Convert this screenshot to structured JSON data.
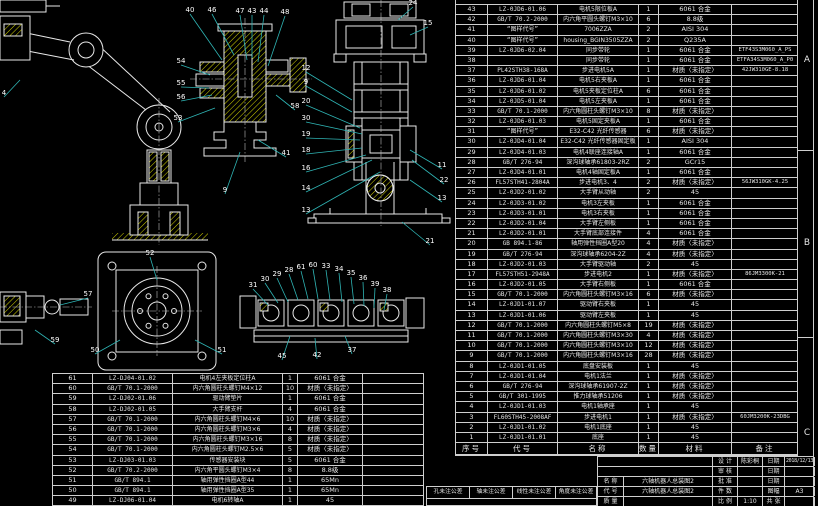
{
  "sheet": {
    "background": "#000000",
    "line_color": "#cfcfcf",
    "hatch_color": "#d6d600",
    "leader_color": "#2fb5b5"
  },
  "zone_letters": [
    "A",
    "B",
    "C"
  ],
  "right_table": {
    "cols": [
      32,
      70,
      81,
      20,
      73,
      66
    ],
    "clipped_top_row": true,
    "header": [
      "序号",
      "代号",
      "名称",
      "数量",
      "材料",
      "备注"
    ],
    "rows": [
      [
        "43",
        "LZ-0JD6-01.06",
        "电机5限位板A",
        "1",
        "6061 合金",
        ""
      ],
      [
        "42",
        "GB/T 70.2-2000",
        "内六角平圆头螺钉M3×10",
        "6",
        "8.8级",
        ""
      ],
      [
        "41",
        "“图样代号”",
        "7006ZZA",
        "2",
        "AISI 304",
        ""
      ],
      [
        "40",
        "“图样代号”",
        "housing_BGIN3505ZZA",
        "2",
        "Q235A",
        ""
      ],
      [
        "39",
        "LZ-0JD6-02.04",
        "同步带轮",
        "1",
        "6061 合金",
        "ETF43S3M060_A_PS"
      ],
      [
        "38",
        "",
        "同步带轮",
        "1",
        "6061 合金",
        "ETFA34S3M060_A_P0"
      ],
      [
        "37",
        "PL42STH38-168A",
        "步进电机5A",
        "1",
        "材质〈未指定〉",
        "42JW310GE-8.18"
      ],
      [
        "36",
        "LZ-0JD6-01.04",
        "电机5右夹板A",
        "1",
        "6061 合金",
        ""
      ],
      [
        "35",
        "LZ-0JD6-01.02",
        "电机5夹板定位柱A",
        "6",
        "6061 合金",
        ""
      ],
      [
        "34",
        "LZ-0JD5-01.04",
        "电机5左夹板A",
        "1",
        "6061 合金",
        ""
      ],
      [
        "33",
        "GB/T 70.1-2000",
        "内六角圆柱头螺钉M3×10",
        "8",
        "材质〈未指定〉",
        ""
      ],
      [
        "32",
        "LZ-0JD6-01.03",
        "电机5固定夹板A",
        "1",
        "6061 合金",
        ""
      ],
      [
        "31",
        "“图样代号”",
        "E32-C42 光纤传感器",
        "6",
        "材质〈未指定〉",
        ""
      ],
      [
        "30",
        "LZ-0JD4-01.04",
        "E32-C42 光纤传感器固定板",
        "1",
        "AISI 304",
        ""
      ],
      [
        "29",
        "LZ-0JD4-01.03",
        "电机4联座连接轴A",
        "1",
        "6061 合金",
        ""
      ],
      [
        "28",
        "GB/T 276-94",
        "深沟球轴承61803-2RZ",
        "2",
        "GCr15",
        ""
      ],
      [
        "27",
        "LZ-0JD4-01.01",
        "电机4轴固定板A",
        "1",
        "6061 合金",
        ""
      ],
      [
        "26",
        "FL57STH41-2804A",
        "步进电机3、4",
        "2",
        "材质〈未指定〉",
        "56JW310GK-4.25"
      ],
      [
        "25",
        "LZ-0JD2-01.02",
        "大手臂从动轴",
        "2",
        "45",
        ""
      ],
      [
        "24",
        "LZ-0JD3-01.02",
        "电机3左夹板",
        "1",
        "6061 合金",
        ""
      ],
      [
        "23",
        "LZ-0JD3-01.01",
        "电机3右夹板",
        "1",
        "6061 合金",
        ""
      ],
      [
        "22",
        "LZ-0JD2-01.04",
        "大手臂左侧板",
        "1",
        "6061 合金",
        ""
      ],
      [
        "21",
        "LZ-0JD2-01.01",
        "大手臂底部连接件",
        "4",
        "6061 合金",
        ""
      ],
      [
        "20",
        "GB 894.1-86",
        "轴用弹性挡圈A型20",
        "4",
        "材质〈未指定〉",
        ""
      ],
      [
        "19",
        "GB/T 276-94",
        "深沟球轴承6204-2Z",
        "4",
        "材质〈未指定〉",
        ""
      ],
      [
        "18",
        "LZ-0JD2-01.03",
        "大手臂驱动轴",
        "2",
        "45",
        ""
      ],
      [
        "17",
        "FL57STH51-2948A",
        "步进电机2",
        "1",
        "材质〈未指定〉",
        "86JM3300K-21"
      ],
      [
        "16",
        "LZ-0JD2-01.05",
        "大手臂右侧板",
        "1",
        "6061 合金",
        ""
      ],
      [
        "15",
        "GB/T 70.1-2000",
        "内六角圆柱头螺钉M3×16",
        "6",
        "材质〈未指定〉",
        ""
      ],
      [
        "14",
        "LZ-0JD1-01.07",
        "驱动臂右夹板",
        "1",
        "45",
        ""
      ],
      [
        "13",
        "LZ-0JD1-01.06",
        "驱动臂左夹板",
        "1",
        "45",
        ""
      ],
      [
        "12",
        "GB/T 70.1-2000",
        "内六角圆柱头螺钉M5×8",
        "19",
        "材质〈未指定〉",
        ""
      ],
      [
        "11",
        "GB/T 70.1-2000",
        "内六角圆柱头螺钉M3×30",
        "4",
        "材质〈未指定〉",
        ""
      ],
      [
        "10",
        "GB/T 70.1-2000",
        "内六角圆柱头螺钉M3×10",
        "12",
        "材质〈未指定〉",
        ""
      ],
      [
        "9",
        "GB/T 70.1-2000",
        "内六角圆柱头螺钉M3×16",
        "28",
        "材质〈未指定〉",
        ""
      ],
      [
        "8",
        "LZ-0JD1-01.05",
        "底盘安装板",
        "1",
        "45",
        ""
      ],
      [
        "7",
        "LZ-0JD1-01.04",
        "电机1法兰",
        "1",
        "材质〈未指定〉",
        ""
      ],
      [
        "6",
        "GB/T 276-94",
        "深沟球轴承61907-2Z",
        "1",
        "材质〈未指定〉",
        ""
      ],
      [
        "5",
        "GB/T 301-1995",
        "推力球轴承51206",
        "1",
        "材质〈未指定〉",
        ""
      ],
      [
        "4",
        "LZ-0JD1-01.03",
        "电机1轴承座",
        "1",
        "45",
        ""
      ],
      [
        "3",
        "FL60STH45-2008AF",
        "步进电机1",
        "1",
        "材质〈未指定〉",
        "60JM3200K-23DBG"
      ],
      [
        "2",
        "LZ-0JD1-01.02",
        "电机1底座",
        "1",
        "45",
        ""
      ],
      [
        "1",
        "LZ-0JD1-01.01",
        "底座",
        "1",
        "45",
        ""
      ]
    ]
  },
  "left_table": {
    "cols": [
      40,
      80,
      110,
      15,
      65,
      60
    ],
    "rows": [
      [
        "61",
        "LZ-DJ04-01.02",
        "电机4左夹板定位柱A",
        "1",
        "6061 合金",
        ""
      ],
      [
        "60",
        "GB/T 70.1-2000",
        "内六角圆柱头螺钉M4×12",
        "10",
        "材质〈未指定〉",
        ""
      ],
      [
        "59",
        "LZ-DJ02-01.06",
        "驱动臂垫片",
        "1",
        "6061 合金",
        ""
      ],
      [
        "58",
        "LZ-DJ02-01.05",
        "大手臂支杆",
        "4",
        "6061 合金",
        ""
      ],
      [
        "57",
        "GB/T 70.1-2000",
        "内六角圆柱头螺钉M4×6",
        "10",
        "材质〈未指定〉",
        ""
      ],
      [
        "56",
        "GB/T 70.1-2000",
        "内六角圆柱头螺钉M3×6",
        "4",
        "材质〈未指定〉",
        ""
      ],
      [
        "55",
        "GB/T 70.1-2000",
        "内六角圆柱头螺钉M3×16",
        "8",
        "材质〈未指定〉",
        ""
      ],
      [
        "54",
        "GB/T 70.1-2000",
        "内六角圆柱头螺钉M2.5×6",
        "5",
        "材质〈未指定〉",
        ""
      ],
      [
        "53",
        "LZ-DJ03-01.03",
        "传感器安装块",
        "5",
        "6061 合金",
        ""
      ],
      [
        "52",
        "GB/T 70.2-2000",
        "内六角平圆头螺钉M3×4",
        "8",
        "8.8级",
        ""
      ],
      [
        "51",
        "GB/T 894.1",
        "轴用弹性挡圈A型44",
        "1",
        "65Mn",
        ""
      ],
      [
        "50",
        "GB/T 894.1",
        "轴用弹性挡圈A型35",
        "1",
        "65Mn",
        ""
      ],
      [
        "49",
        "LZ-DJ06-01.04",
        "电机6转轴A",
        "1",
        "45",
        ""
      ]
    ]
  },
  "tolerance_block": {
    "labels": [
      "孔未注公差",
      "轴未注公差",
      "线性未注公差",
      "角度未注公差"
    ]
  },
  "title_block": {
    "designer_label": "设 计",
    "designer": "陈彩桐",
    "design_date_label": "日期",
    "design_date": "2018/12/13",
    "checker_label": "审 核",
    "check_date_label": "日期",
    "approver_label": "批 准",
    "approve_date_label": "日期",
    "name_label": "名 称",
    "name_value": "六轴机器人总装图2",
    "code_label": "代 号",
    "code_value": "六轴机器人总装图2",
    "qty_label": "件 数",
    "sheet_label": "图幅",
    "sheet_size": "A3",
    "mass_label": "质 量",
    "scale_label": "比 例",
    "scale_value": "1:10",
    "pages_label": "共  张"
  },
  "drawing": {
    "balloons": [
      {
        "x": 190,
        "y": 12,
        "n": "40",
        "tx": 222,
        "ty": 60
      },
      {
        "x": 212,
        "y": 12,
        "n": "46",
        "tx": 234,
        "ty": 55
      },
      {
        "x": 240,
        "y": 13,
        "n": "47",
        "tx": 247,
        "ty": 60
      },
      {
        "x": 252,
        "y": 13,
        "n": "43",
        "tx": 252,
        "ty": 58
      },
      {
        "x": 264,
        "y": 13,
        "n": "44",
        "tx": 258,
        "ty": 62
      },
      {
        "x": 285,
        "y": 14,
        "n": "48",
        "tx": 268,
        "ty": 66
      },
      {
        "x": 181,
        "y": 63,
        "n": "54",
        "tx": 210,
        "ty": 75
      },
      {
        "x": 181,
        "y": 85,
        "n": "55",
        "tx": 209,
        "ty": 88
      },
      {
        "x": 181,
        "y": 99,
        "n": "56",
        "tx": 212,
        "ty": 95
      },
      {
        "x": 178,
        "y": 120,
        "n": "53",
        "tx": 215,
        "ty": 108
      },
      {
        "x": 295,
        "y": 108,
        "n": "58",
        "tx": 276,
        "ty": 95
      },
      {
        "x": 286,
        "y": 155,
        "n": "41",
        "tx": 258,
        "ty": 140
      },
      {
        "x": 225,
        "y": 192,
        "n": "9",
        "tx": 240,
        "ty": 152
      },
      {
        "x": 306,
        "y": 70,
        "n": "12",
        "tx": 352,
        "ty": 100
      },
      {
        "x": 306,
        "y": 84,
        "n": "9",
        "tx": 352,
        "ty": 112
      },
      {
        "x": 306,
        "y": 103,
        "n": "20",
        "tx": 360,
        "ty": 128
      },
      {
        "x": 306,
        "y": 120,
        "n": "30",
        "tx": 362,
        "ty": 134
      },
      {
        "x": 306,
        "y": 136,
        "n": "19",
        "tx": 360,
        "ty": 140
      },
      {
        "x": 306,
        "y": 152,
        "n": "18",
        "tx": 362,
        "ty": 148
      },
      {
        "x": 306,
        "y": 170,
        "n": "16",
        "tx": 366,
        "ty": 155
      },
      {
        "x": 306,
        "y": 190,
        "n": "14",
        "tx": 372,
        "ty": 160
      },
      {
        "x": 306,
        "y": 212,
        "n": "13",
        "tx": 380,
        "ty": 172
      },
      {
        "x": 413,
        "y": 5,
        "n": "24",
        "tx": 398,
        "ty": 20
      },
      {
        "x": 428,
        "y": 25,
        "n": "15",
        "tx": 410,
        "ty": 35
      },
      {
        "x": 442,
        "y": 167,
        "n": "11",
        "tx": 410,
        "ty": 150
      },
      {
        "x": 444,
        "y": 182,
        "n": "22",
        "tx": 412,
        "ty": 160
      },
      {
        "x": 442,
        "y": 200,
        "n": "13",
        "tx": 410,
        "ty": 180
      },
      {
        "x": 430,
        "y": 243,
        "n": "21",
        "tx": 402,
        "ty": 222
      },
      {
        "x": 253,
        "y": 287,
        "n": "31",
        "tx": 268,
        "ty": 305
      },
      {
        "x": 265,
        "y": 281,
        "n": "30",
        "tx": 278,
        "ty": 303
      },
      {
        "x": 277,
        "y": 276,
        "n": "29",
        "tx": 288,
        "ty": 302
      },
      {
        "x": 289,
        "y": 272,
        "n": "28",
        "tx": 298,
        "ty": 300
      },
      {
        "x": 301,
        "y": 269,
        "n": "61",
        "tx": 308,
        "ty": 299
      },
      {
        "x": 313,
        "y": 267,
        "n": "60",
        "tx": 318,
        "ty": 299
      },
      {
        "x": 326,
        "y": 268,
        "n": "33",
        "tx": 330,
        "ty": 300
      },
      {
        "x": 339,
        "y": 271,
        "n": "34",
        "tx": 342,
        "ty": 302
      },
      {
        "x": 351,
        "y": 275,
        "n": "35",
        "tx": 354,
        "ty": 304
      },
      {
        "x": 363,
        "y": 280,
        "n": "36",
        "tx": 364,
        "ty": 306
      },
      {
        "x": 375,
        "y": 286,
        "n": "39",
        "tx": 374,
        "ty": 308
      },
      {
        "x": 387,
        "y": 292,
        "n": "38",
        "tx": 384,
        "ty": 310
      },
      {
        "x": 352,
        "y": 352,
        "n": "37",
        "tx": 345,
        "ty": 336
      },
      {
        "x": 317,
        "y": 357,
        "n": "42",
        "tx": 315,
        "ty": 338
      },
      {
        "x": 282,
        "y": 358,
        "n": "45",
        "tx": 290,
        "ty": 336
      },
      {
        "x": 150,
        "y": 255,
        "n": "52",
        "tx": 157,
        "ty": 280
      },
      {
        "x": 222,
        "y": 352,
        "n": "51",
        "tx": 195,
        "ty": 340
      },
      {
        "x": 95,
        "y": 352,
        "n": "50",
        "tx": 120,
        "ty": 340
      },
      {
        "x": 88,
        "y": 296,
        "n": "57",
        "tx": 60,
        "ty": 305
      },
      {
        "x": 55,
        "y": 342,
        "n": "59",
        "tx": 35,
        "ty": 330
      },
      {
        "x": 4,
        "y": 95,
        "n": "4",
        "tx": 20,
        "ty": 80
      }
    ]
  }
}
